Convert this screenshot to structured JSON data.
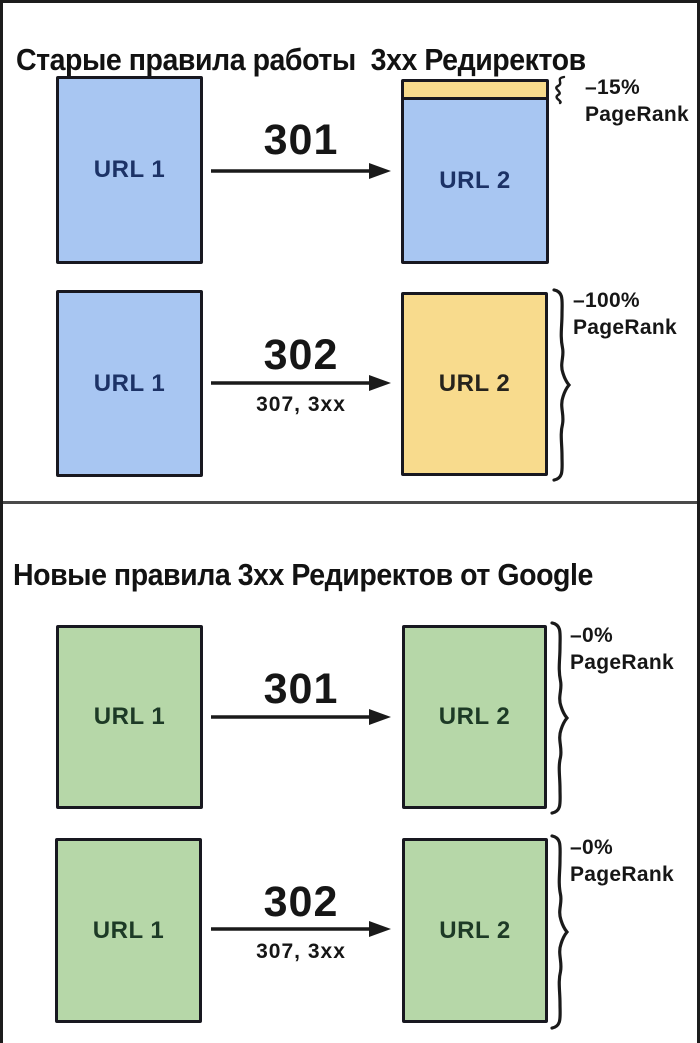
{
  "colors": {
    "blue_fill": "#a8c6f2",
    "yellow_fill": "#f8db8d",
    "green_fill": "#b6d7a8",
    "box_border": "#181820",
    "ink": "#1a1a1a",
    "navy_text": "#1c3266",
    "yellow_text": "#26231c",
    "green_text": "#1d3a26",
    "divider": "#4a4a4a"
  },
  "panels": [
    {
      "title": "Старые правила работы  3хх Редиректов",
      "rows": [
        {
          "source": {
            "label": "URL 1",
            "fill": "blue"
          },
          "arrow": {
            "code": "301",
            "sub": ""
          },
          "target": {
            "label": "URL 2",
            "fill": "blue",
            "loss_strip": "yellow"
          },
          "annotation": {
            "brace": "small",
            "value": "–15%",
            "label": "PageRank"
          }
        },
        {
          "source": {
            "label": "URL 1",
            "fill": "blue"
          },
          "arrow": {
            "code": "302",
            "sub": "307, 3xx"
          },
          "target": {
            "label": "URL 2",
            "fill": "yellow"
          },
          "annotation": {
            "brace": "large",
            "value": "–100%",
            "label": "PageRank"
          }
        }
      ]
    },
    {
      "title": "Новые правила 3хх Редиректов от Google",
      "rows": [
        {
          "source": {
            "label": "URL 1",
            "fill": "green"
          },
          "arrow": {
            "code": "301",
            "sub": ""
          },
          "target": {
            "label": "URL 2",
            "fill": "green"
          },
          "annotation": {
            "brace": "large",
            "value": "–0%",
            "label": "PageRank"
          }
        },
        {
          "source": {
            "label": "URL 1",
            "fill": "green"
          },
          "arrow": {
            "code": "302",
            "sub": "307, 3xx"
          },
          "target": {
            "label": "URL 2",
            "fill": "green"
          },
          "annotation": {
            "brace": "large",
            "value": "–0%",
            "label": "PageRank"
          }
        }
      ]
    }
  ]
}
